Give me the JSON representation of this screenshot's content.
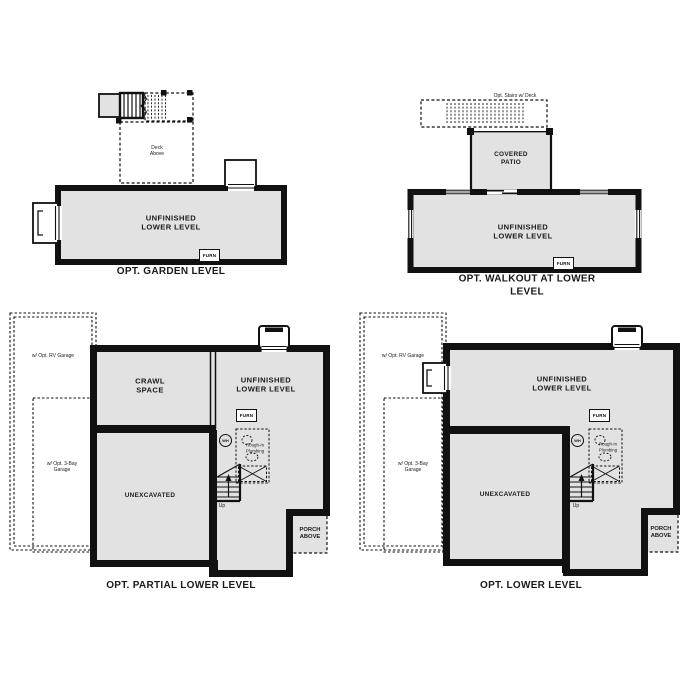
{
  "colors": {
    "room_fill": "#e2e2e2",
    "wall": "#111111",
    "background": "#ffffff"
  },
  "plans": {
    "garden": {
      "title": "OPT. GARDEN LEVEL",
      "room_label": "UNFINISHED\nLOWER LEVEL",
      "deck_label": "Deck\nAbove",
      "furnace_label": "FURN"
    },
    "walkout": {
      "title": "OPT. WALKOUT AT LOWER LEVEL",
      "room_label": "UNFINISHED\nLOWER LEVEL",
      "patio_label": "COVERED\nPATIO",
      "stairs_label": "Opt. Stairs w/ Deck",
      "furnace_label": "FURN"
    },
    "partial": {
      "title": "OPT. PARTIAL LOWER LEVEL",
      "crawl_label": "CRAWL\nSPACE",
      "room_label": "UNFINISHED\nLOWER LEVEL",
      "unexcavated_label": "UNEXCAVATED",
      "furnace_label": "FURN",
      "water_heater_label": "WH",
      "plumbing_label": "Rough-In\nPlumbing",
      "up_label": "Up",
      "porch_label": "PORCH\nABOVE",
      "rv_garage_label": "w/ Opt. RV Garage",
      "bay_garage_label": "w/ Opt. 3-Bay\nGarage"
    },
    "lower": {
      "title": "OPT. LOWER LEVEL",
      "room_label": "UNFINISHED\nLOWER LEVEL",
      "unexcavated_label": "UNEXCAVATED",
      "furnace_label": "FURN",
      "water_heater_label": "WH",
      "plumbing_label": "Rough-In\nPlumbing",
      "up_label": "Up",
      "porch_label": "PORCH\nABOVE",
      "rv_garage_label": "w/ Opt. RV Garage",
      "bay_garage_label": "w/ Opt. 3-Bay\nGarage"
    }
  }
}
